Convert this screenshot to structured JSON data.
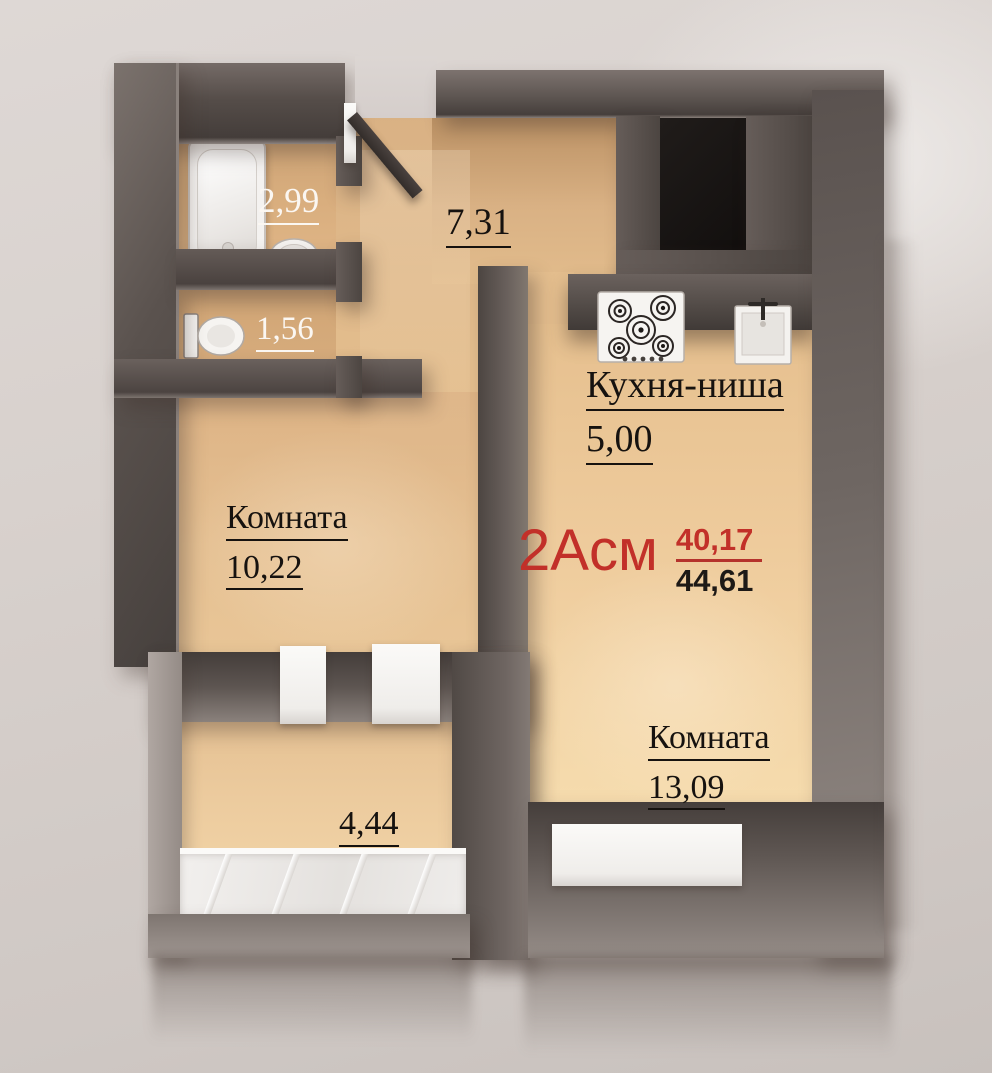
{
  "plan_summary": {
    "type_label": "2Асм",
    "upper_area": "40,17",
    "lower_area": "44,61"
  },
  "rooms": {
    "bathroom": {
      "area": "2,99"
    },
    "toilet": {
      "area": "1,56"
    },
    "hallway": {
      "area": "7,31"
    },
    "kitchen_niche": {
      "name": "Кухня-ниша",
      "area": "5,00"
    },
    "room_left": {
      "name": "Комната",
      "area": "10,22"
    },
    "room_right": {
      "name": "Комната",
      "area": "13,09"
    },
    "loggia": {
      "area": "4,44"
    }
  },
  "fixtures": {
    "bathtub": "bathtub",
    "washbasin": "washbasin",
    "toilet": "toilet",
    "stove": "stove-5-burner",
    "kitchen_sink": "kitchen-sink",
    "loggia_glazing": "balcony-glazing",
    "window": "window-opening",
    "entrance_door": "entrance-door-leaf",
    "vent_shaft": "ventilation-shaft"
  },
  "colors": {
    "accent_red": "#c23029",
    "text_black": "#16120f",
    "text_white": "#fbf7f2",
    "wall_dark": "#4e4643",
    "floor_tan": "#e3bd8d",
    "background": "#d8d1cd"
  }
}
